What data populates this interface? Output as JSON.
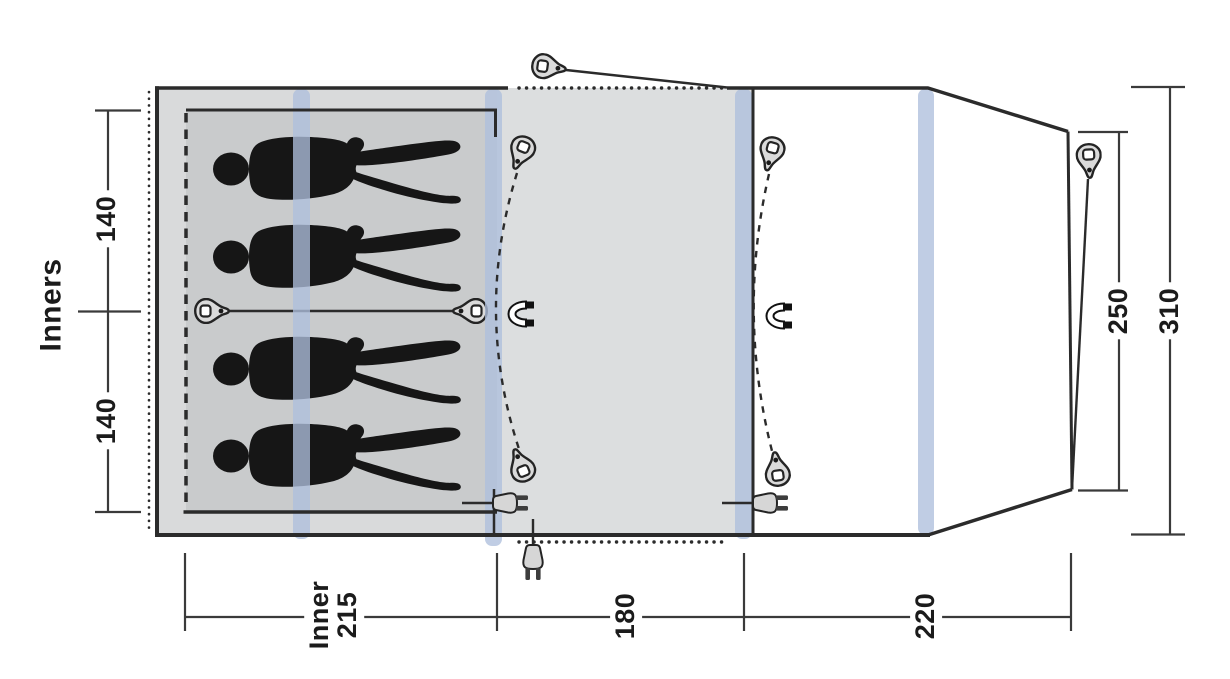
{
  "diagram": {
    "kind": "tent-floorplan-top-view",
    "labels": {
      "inners": "Inners",
      "inner_cabin_width_top": "140",
      "inner_cabin_width_bottom": "140",
      "inner_depth_line1": "Inner",
      "inner_depth_line2": "215",
      "living_depth": "180",
      "porch_depth": "220",
      "porch_width_inner": "250",
      "porch_width_outer": "310"
    },
    "icons": {
      "guy_peg": "peg-toggle-icon",
      "magnet": "magnetic-door-closure-icon",
      "power_plug": "cable-entry-plug-icon",
      "person": "sleeping-person-silhouette",
      "air_pole": "pole-position-stripe"
    },
    "figure_count": 4,
    "palette": {
      "pole_blue": "#aebfdd",
      "fabric_light": "#d9dadb",
      "fabric_mid": "#dcdedf",
      "fabric_inner": "#c9cbcc",
      "canopy_white": "#ffffff",
      "line_dark": "#2b2b2b",
      "dim_line": "#3a3a3a",
      "figure_black": "#161616"
    }
  }
}
